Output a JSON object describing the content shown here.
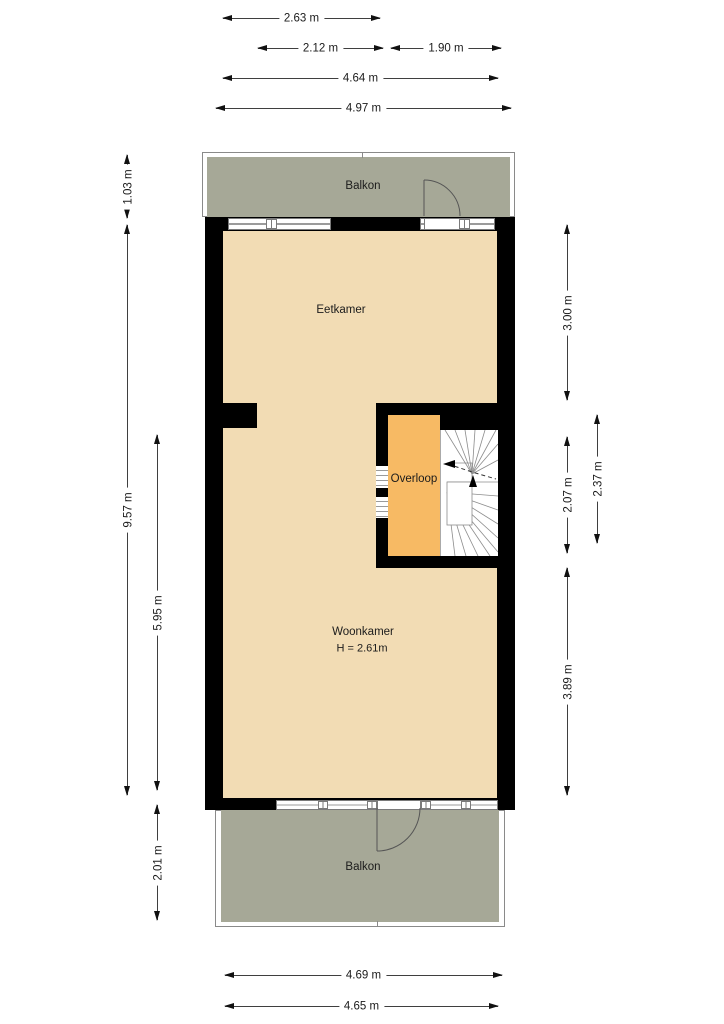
{
  "rooms": {
    "balkon_top": "Balkon",
    "eetkamer": "Eetkamer",
    "overloop": "Overloop",
    "woonkamer": "Woonkamer",
    "woonkamer_height": "H = 2.61m",
    "balkon_bottom": "Balkon"
  },
  "dimensions": {
    "top": [
      "2.63 m",
      "2.12 m",
      "1.90 m",
      "4.64 m",
      "4.97 m"
    ],
    "bottom": [
      "4.69 m",
      "4.65 m"
    ],
    "left": [
      "1.03 m",
      "9.57 m",
      "5.95 m",
      "2.01 m"
    ],
    "right": [
      "3.00 m",
      "2.37 m",
      "2.07 m",
      "3.89 m"
    ]
  },
  "colors": {
    "room_fill": "#f2dcb4",
    "balcony_fill": "#a6a897",
    "overloop_fill": "#f7ba64",
    "wall": "#000000",
    "text": "#1b1b1b"
  }
}
